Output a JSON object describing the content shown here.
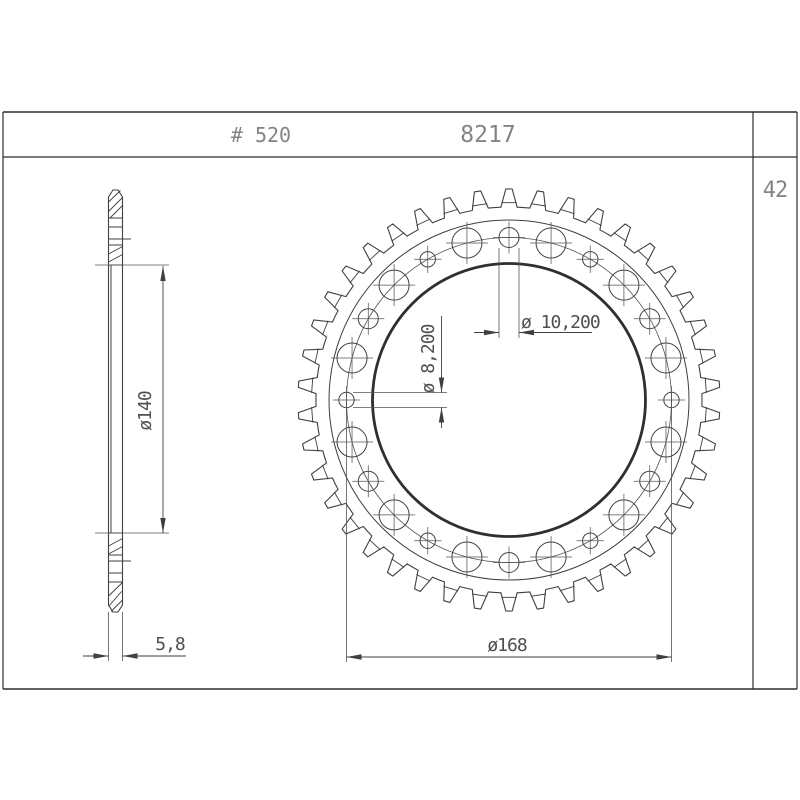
{
  "title_block": {
    "chain_size": "# 520",
    "part_number": "8217",
    "teeth_count": "42"
  },
  "dimensions": {
    "bore_diameter": {
      "label": "ø140",
      "value": 140
    },
    "thickness": {
      "label": "5,8",
      "value": 5.8
    },
    "bolt_hole_diameter": {
      "label": "ø 10,200",
      "value": 10.2
    },
    "small_hole_diameter": {
      "label": "ø 8,200",
      "value": 8.2
    },
    "bolt_circle_diameter": {
      "label": "ø168",
      "value": 168
    }
  },
  "drawing": {
    "colors": {
      "line": "#3f3f3f",
      "thin": "#555555",
      "bold": "#2f2f2f",
      "frame": "#2e2e2e",
      "bg": "#ffffff"
    },
    "frame": {
      "x1": 3,
      "y1": 112,
      "x2": 797,
      "y2": 689,
      "band_y": 157,
      "divider_x": 753
    },
    "front_view": {
      "cx": 509,
      "cy": 400,
      "teeth": 42,
      "r_tip": 211,
      "r_valley": 193,
      "r_root_chord": 197.5,
      "r_ring": 180,
      "r_bolt_circle": 162.5,
      "r_bore": 136.5,
      "hole_step_deg": 15,
      "hole_r_large": 15,
      "hole_r_bolt": 10,
      "hole_r_small": 7.7
    },
    "side_view": {
      "x_left": 108.5,
      "x_right": 122.5,
      "y_top": 190,
      "y_bottom": 612,
      "chamfer_x": 4.5,
      "chamfer_y": 7,
      "h_lines": [
        218,
        227,
        245,
        265,
        533,
        555,
        573,
        582
      ],
      "ticks": [
        [
          239,
          131
        ],
        [
          561,
          131
        ]
      ],
      "inner_vertical": [
        111,
        265,
        533
      ],
      "hatch": [
        [
          108.5,
          202,
          120.5,
          190.5
        ],
        [
          108.5,
          211.5,
          122.5,
          197.5
        ],
        [
          110,
          218,
          122.5,
          205.5
        ],
        [
          108.5,
          254,
          122.5,
          246.5
        ],
        [
          108.5,
          262,
          122.5,
          254.5
        ],
        [
          108.5,
          546,
          122.5,
          538.5
        ],
        [
          108.5,
          554,
          122.5,
          546.5
        ],
        [
          108.5,
          596,
          122.5,
          582.5
        ],
        [
          108.5,
          606.5,
          121.5,
          591.5
        ],
        [
          111,
          611.5,
          122.5,
          600
        ]
      ],
      "ext_lines": [
        [
          108.5,
          612,
          108.5,
          661
        ],
        [
          122.5,
          612,
          122.5,
          661
        ]
      ]
    },
    "dims": {
      "bore": {
        "ext": [
          [
            95,
            265,
            169,
            265
          ],
          [
            95,
            533,
            169,
            533
          ]
        ],
        "lines": [
          [
            163,
            266,
            163,
            533
          ]
        ],
        "arrows": [
          [
            163,
            266,
            270
          ],
          [
            163,
            533,
            90
          ]
        ]
      },
      "thickness": {
        "ext": [],
        "lines": [
          [
            83,
            656,
            108.5,
            656
          ],
          [
            122.5,
            656,
            186,
            656
          ]
        ],
        "arrows": [
          [
            108.5,
            656,
            0
          ],
          [
            122.5,
            656,
            180
          ]
        ]
      },
      "bolt_hole": {
        "ext": [
          [
            499,
            248,
            499,
            338
          ],
          [
            519,
            248,
            519,
            338
          ]
        ],
        "lines": [
          [
            474,
            332.5,
            499,
            332.5
          ],
          [
            519,
            332.5,
            592,
            332.5
          ]
        ],
        "arrows": [
          [
            499,
            332.5,
            0
          ],
          [
            519,
            332.5,
            180
          ]
        ]
      },
      "small_hole": {
        "ext": [
          [
            353,
            392.5,
            447,
            392.5
          ],
          [
            353,
            407.5,
            447,
            407.5
          ]
        ],
        "lines": [
          [
            441.5,
            316,
            441.5,
            392.5
          ],
          [
            441.5,
            407.5,
            441.5,
            428
          ]
        ],
        "arrows": [
          [
            441.5,
            392.5,
            90
          ],
          [
            441.5,
            407.5,
            270
          ]
        ]
      },
      "bolt_circle": {
        "ext": [
          [
            346.5,
            400,
            346.5,
            662
          ],
          [
            671.5,
            400,
            671.5,
            662
          ]
        ],
        "lines": [
          [
            346.5,
            657,
            671.5,
            657
          ]
        ],
        "arrows": [
          [
            346.5,
            657,
            180
          ],
          [
            671.5,
            657,
            0
          ]
        ]
      }
    }
  }
}
